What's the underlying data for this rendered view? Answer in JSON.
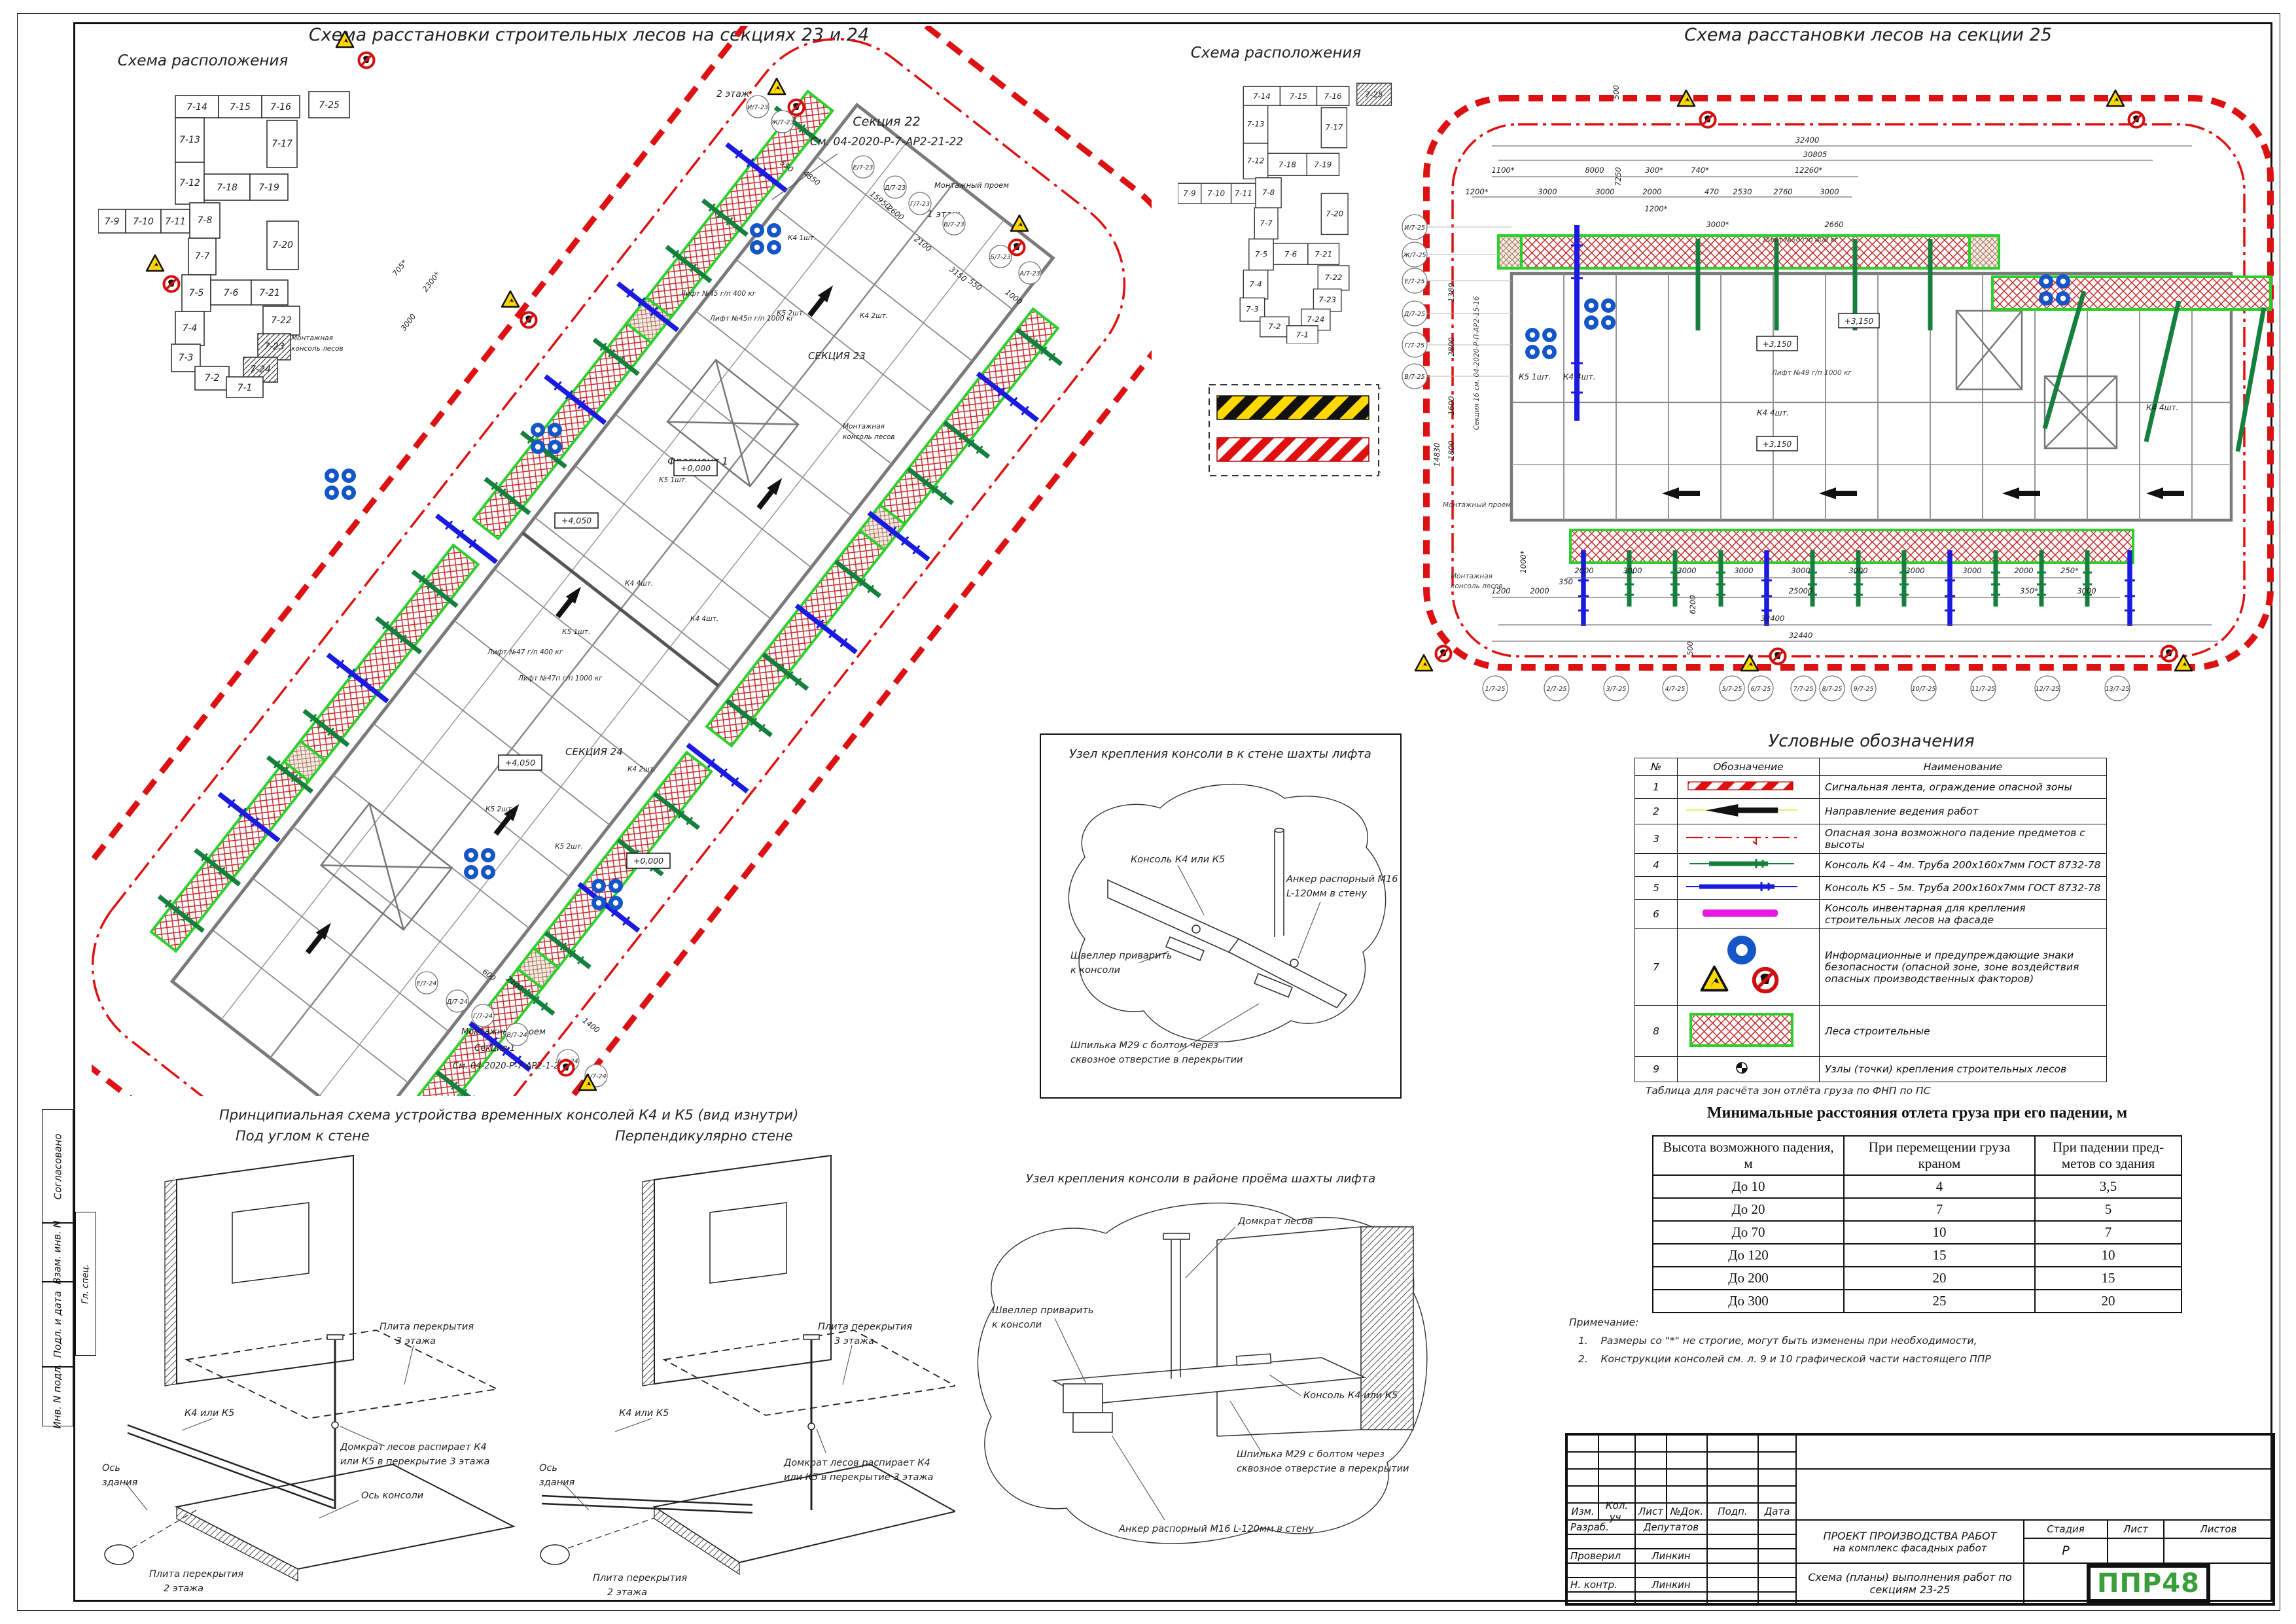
{
  "sheet": {
    "margin": [
      "Согласовано",
      "Гл. спец.",
      "Взам. инв. N",
      "Подл. и дата",
      "Инв. N подл."
    ]
  },
  "loc": {
    "title": "Схема расположения",
    "sections": [
      "7-14",
      "7-15",
      "7-16",
      "7-25",
      "7-13",
      "7-17",
      "7-12",
      "7-18",
      "7-19",
      "7-9",
      "7-10",
      "7-11",
      "7-8",
      "7-7",
      "7-20",
      "7-5",
      "7-6",
      "7-21",
      "7-4",
      "7-22",
      "7-3",
      "7-23",
      "7-2",
      "7-24",
      "7-1"
    ]
  },
  "plan2324": {
    "title": "Схема расстановки строительных лесов на секциях 23 и 24",
    "sec23": "СЕКЦИЯ 23",
    "sec24": "СЕКЦИЯ 24",
    "callout_top": [
      "Секция 22",
      "См. 04-2020-Р-7-АР2-21-22"
    ],
    "callout_bottom": [
      "Монтажный проем",
      "Секция 1",
      "См. 04-2020-Р-7-АР2-1-2"
    ],
    "floor2": "2 этаж",
    "floor1": "1 этаж",
    "opening": "Монтажный проем",
    "fragment": "Фрагмент 1",
    "mount_console": [
      "Монтажная",
      "консоль лесов"
    ],
    "console_notes": [
      "К4 1шт.",
      "К5 2шт.",
      "К4 2шт.",
      "К5 1шт.",
      "К4 4шт.",
      "К5 2шт.",
      "К4 2шт.",
      "К5 2шт.",
      "К4 4шт.",
      "К5 1шт."
    ],
    "elevations": [
      "+0,000",
      "+4,050",
      "+0,000",
      "+4,050"
    ],
    "lifts": [
      "Лифт №45 г/п 400 кг",
      "Лифт №45п г/п 1000 кг",
      "Лифт №47 г/п 400 кг",
      "Лифт №47п г/п 1000 кг"
    ],
    "grid_top": [
      "И/7-23",
      "Ж/7-23",
      "Е/7-23",
      "Д/7-23",
      "Г/7-23",
      "В/7-23",
      "Б/7-23",
      "А/7-23"
    ],
    "grid_bottom": [
      "Е/7-24",
      "Д/7-24",
      "Г/7-24",
      "В/7-24",
      "Б/7-24",
      "А/7-24"
    ],
    "dims": [
      "550",
      "4850",
      "15950",
      "2600",
      "2100",
      "3150",
      "550",
      "1000",
      "2300*",
      "705*",
      "3000",
      "1400",
      "600",
      "2100"
    ]
  },
  "plan25": {
    "title": "Схема расстановки лесов на секции 25",
    "grid_left": [
      "И/7-25",
      "Ж/7-25",
      "Е/7-25",
      "Д/7-25",
      "Г/7-25",
      "В/7-25"
    ],
    "grid_bottom": [
      "1/7-25",
      "2/7-25",
      "3/7-25",
      "4/7-25",
      "5/7-25",
      "6/7-25",
      "7/7-25",
      "8/7-25",
      "9/7-25",
      "10/7-25",
      "11/7-25",
      "12/7-25",
      "13/7-25"
    ],
    "dims_top": [
      "32400",
      "30805",
      "1100*",
      "8000",
      "300*",
      "740*",
      "12260*",
      "1200*",
      "3000",
      "3000",
      "2000",
      "470",
      "2530",
      "2760",
      "3000",
      "1200*",
      "3000*",
      "2660",
      "500",
      "7250"
    ],
    "dims_bottom": [
      "2000",
      "3000",
      "3000",
      "3000",
      "3000",
      "3000",
      "3000",
      "3000",
      "2000",
      "250*",
      "1200",
      "2000",
      "350",
      "25000",
      "350*",
      "3000",
      "32400",
      "32440"
    ],
    "dims_left": [
      "1380",
      "2800",
      "1600",
      "1800",
      "14830"
    ],
    "dims_misc": [
      "1000*",
      "6200",
      "500"
    ],
    "lift50": "Лифт №50 г/п 400 кг",
    "lift49": "Лифт №49 г/п 1000 кг",
    "k5": "К5 1шт.",
    "k4a": "К4 4шт.",
    "k4b": "К4 4шт.",
    "k4c": "К4 4шт.",
    "elev": "+3,150",
    "opening": "Монтажный проем",
    "mount_console": [
      "Монтажная",
      "консоль лесов"
    ],
    "section16": "Секция 16 см. 04-2020-Р-П-АР2-15-16"
  },
  "legend": {
    "title": "Условные обозначения",
    "headers": [
      "№",
      "Обозначение",
      "Наименование"
    ],
    "rows": [
      {
        "num": "1",
        "name": "Сигнальная лента, ограждение опасной зоны"
      },
      {
        "num": "2",
        "name": "Направление ведения работ"
      },
      {
        "num": "3",
        "name": "Опасная зона возможного падение предметов с высоты"
      },
      {
        "num": "4",
        "name": "Консоль К4 – 4м. Труба 200х160х7мм ГОСТ 8732-78"
      },
      {
        "num": "5",
        "name": "Консоль К5 – 5м. Труба 200х160х7мм ГОСТ 8732-78"
      },
      {
        "num": "6",
        "name": "Консоль инвентарная для крепления строительных лесов на фасаде"
      },
      {
        "num": "7",
        "name": "Информационные и предупреждающие знаки безопасности (опасной зоне, зоне воздействия опасных производственных факторов)"
      },
      {
        "num": "8",
        "name": "Леса строительные"
      },
      {
        "num": "9",
        "name": "Узлы (точки) крепления строительных лесов"
      }
    ]
  },
  "drop_table": {
    "note": "Таблица для расчёта зон отлёта груза по ФНП по ПС",
    "title": "Минимальные расстояния отлета груза при его падении, м",
    "headers": [
      "Высота возможного падения, м",
      "При перемещении груза краном",
      "При падении пред-метов со здания"
    ],
    "rows": [
      [
        "До 10",
        "4",
        "3,5"
      ],
      [
        "До 20",
        "7",
        "5"
      ],
      [
        "До 70",
        "10",
        "7"
      ],
      [
        "До 120",
        "15",
        "10"
      ],
      [
        "До 200",
        "20",
        "15"
      ],
      [
        "До 300",
        "25",
        "20"
      ]
    ]
  },
  "notes": {
    "title": "Примечание:",
    "n1": "1.",
    "t1": "Размеры со \"*\" не строгие, могут быть изменены при необходимости,",
    "n2": "2.",
    "t2": "Конструкции консолей см. л. 9 и 10 графической части настоящего ППР"
  },
  "detail1": {
    "title": "Узел крепления консоли в к стене шахты лифта",
    "l_console": "Консоль К4 или К5",
    "l_anchor1": "Анкер распорный М16",
    "l_anchor2": "L-120мм в стену",
    "l_channel1": "Швеллер приварить",
    "l_channel2": "к консоли",
    "l_stud1": "Шпилька М29 с болтом через",
    "l_stud2": "сквозное отверстие в перекрытии"
  },
  "detail2": {
    "title": "Узел крепления консоли в районе проёма шахты лифта",
    "l_jack": "Домкрат лесов",
    "l_console": "Консоль К4 или К5",
    "l_anchor": "Анкер распорный М16 L-120мм в стену",
    "l_channel1": "Швеллер приварить",
    "l_channel2": "к консоли",
    "l_stud1": "Шпилька М29 с болтом через",
    "l_stud2": "сквозное отверстие в перекрытии"
  },
  "principal": {
    "title": "Принципиальная схема устройства временных консолей К4 и К5 (вид изнутри)",
    "subL": "Под углом к стене",
    "subR": "Перпендикулярно стене",
    "slab3a": "Плита перекрытия",
    "slab3b": "3 этажа",
    "k45": "К4 или К5",
    "axis1": "Ось",
    "axis2": "здания",
    "jack1": "Домкрат лесов распирает К4",
    "jack2": "или К5 в перекрытие 3 этажа",
    "axisc": "Ось консоли",
    "slab2a": "Плита перекрытия",
    "slab2b": "2 этажа"
  },
  "titleblock": {
    "cols": [
      "Изм.",
      "Кол. уч.",
      "Лист",
      "№Док.",
      "Подп.",
      "Дата"
    ],
    "sign_rows": [
      {
        "role": "Разраб.",
        "name": "Депутатов"
      },
      {
        "role": "Проверил",
        "name": "Линкин"
      },
      {
        "role": "Н. контр.",
        "name": "Линкин"
      }
    ],
    "project1": "ПРОЕКТ ПРОИЗВОДСТВА РАБОТ",
    "project2": "на комплекс фасадных работ",
    "doc1": "Схема (планы) выполнения работ по",
    "doc2": "секциям 23-25",
    "stage_label": "Стадия",
    "sheet_label": "Лист",
    "sheets_label": "Листов",
    "stage": "Р",
    "logo": "ППР48"
  },
  "colors": {
    "k4": "#15803d",
    "k5": "#1a1ae0",
    "scaffold_border": "#2bd12b",
    "hatch_red": "#c62828",
    "signal_red": "#dd1111",
    "magenta": "#e619e6",
    "warn_yellow": "#ffd900",
    "ppe_blue": "#1456c8",
    "logo_green": "#3a9e3a"
  }
}
